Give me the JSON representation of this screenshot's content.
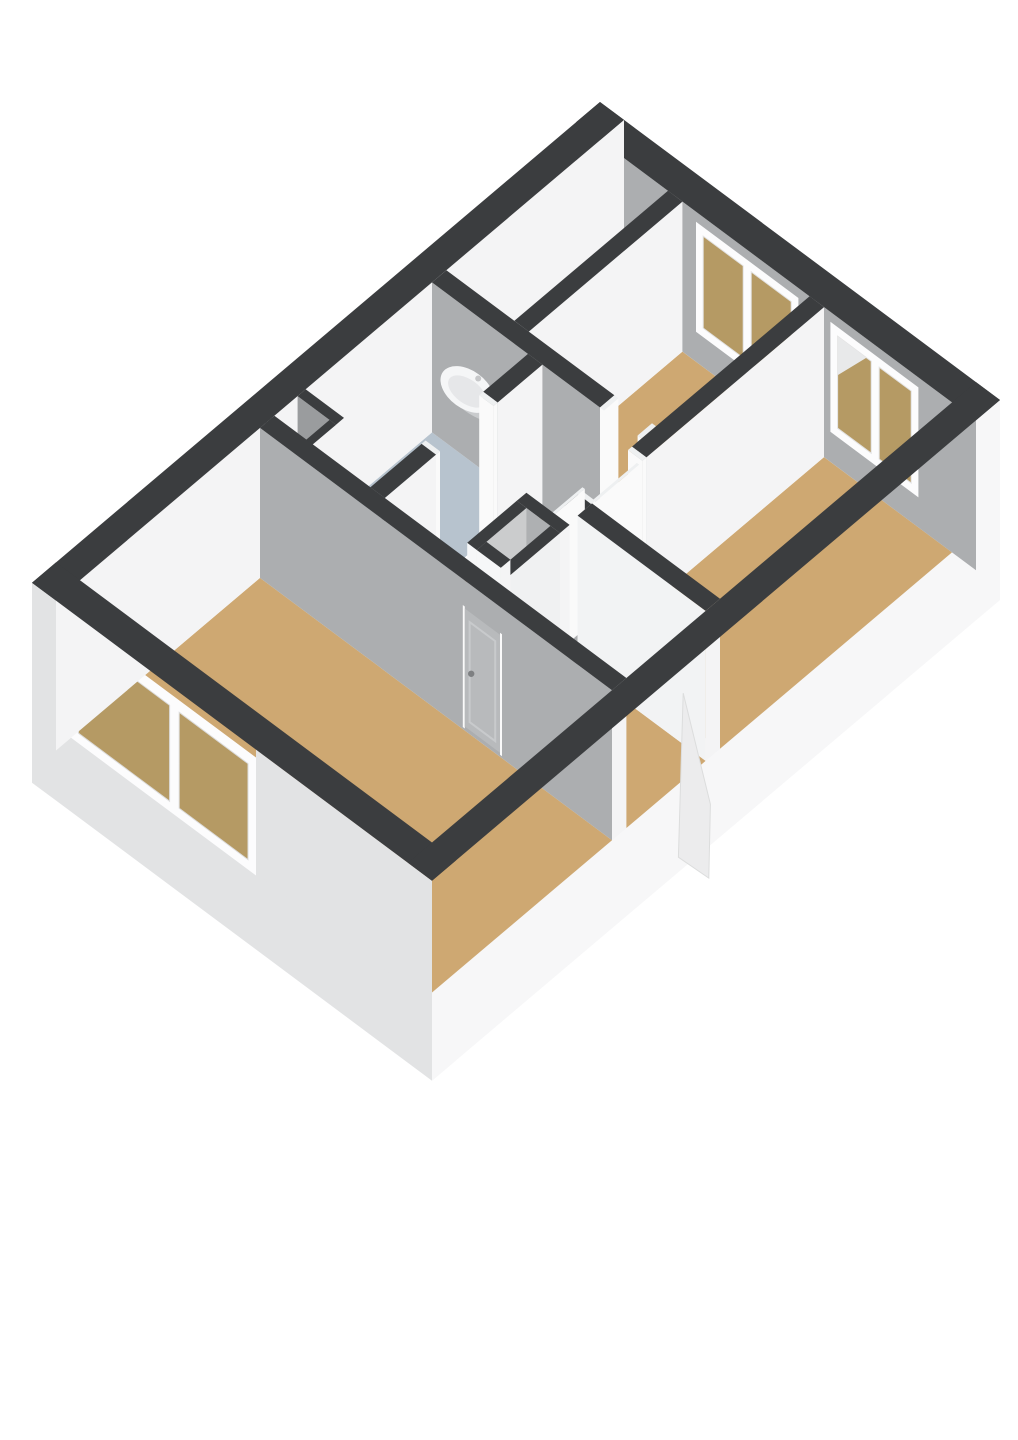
{
  "scene": {
    "kind": "3d-floorplan-render",
    "background": "#ffffff",
    "projection": "isometric-top-down",
    "canvas": {
      "width": 1018,
      "height": 1440
    }
  },
  "colors": {
    "wall_top": "#3b3d3f",
    "face_light": "#f4f4f5",
    "face_shaded": "#acaeb0",
    "ext_face_sw": "#e2e3e4",
    "ext_face_se": "#f7f7f8",
    "floor_wood": "#cea872",
    "floor_bath": "#b7c3ce",
    "floor_gray": "#d7d8d9",
    "closet_floor": "#c6c7c9",
    "closet_cavity_face": "#aeb0b2",
    "closet_inner_face": "#cbcccd",
    "closet_outer_white": "#f6f7f8",
    "shaft_dark": "#8f9193",
    "shaft_inner": "#9a9c9e",
    "window_frame": "#fcfcfd",
    "glass": "#b59a64",
    "glass_sparkle": "#e8e9ea",
    "door_panel": "#b8babc",
    "door_trim": "#c8cacc",
    "jamb_white": "#fafafa",
    "jamb_top": "#eef0f1",
    "handle": "#7e8082",
    "flap": "#ececed",
    "flap_edge": "#dcdddd",
    "sink_white": "#f5f6f7",
    "sink_inner": "#e6e7e9",
    "sink_shadow": "#c9cbcd",
    "bright_wall_override": "#f2f3f4"
  },
  "rooms": [
    {
      "id": "living-room",
      "floor": "wood",
      "features": [
        "large-two-pane-window",
        "closed-door-with-handle"
      ]
    },
    {
      "id": "bathroom",
      "floor": "tile-blue",
      "fixtures": [
        "washbasin"
      ]
    },
    {
      "id": "bedroom-1",
      "floor": "wood",
      "features": [
        "two-pane-window",
        "open-doorway"
      ]
    },
    {
      "id": "bedroom-2",
      "floor": "wood",
      "features": [
        "two-pane-window",
        "open-doorway"
      ]
    },
    {
      "id": "hallway",
      "floor": "wood",
      "features": [
        "storage-closet",
        "front-door-open"
      ]
    },
    {
      "id": "storage-closet",
      "floor": "concrete",
      "features": []
    },
    {
      "id": "duct-shaft",
      "floor": "none",
      "features": []
    }
  ],
  "windows": [
    {
      "room": "bedroom-1",
      "panes": 2,
      "wall": "top-right"
    },
    {
      "room": "bedroom-2",
      "panes": 2,
      "wall": "top-right",
      "reflection": true
    },
    {
      "room": "living-room",
      "panes": 2,
      "wall": "bottom-left"
    }
  ],
  "doors": [
    {
      "room": "living-room",
      "state": "closed",
      "handle": true
    },
    {
      "room": "bathroom",
      "state": "open"
    },
    {
      "room": "bedroom-1",
      "state": "open"
    },
    {
      "room": "bedroom-2",
      "state": "open"
    },
    {
      "room": "entrance",
      "state": "open",
      "leaf_outside": true
    }
  ],
  "fixtures": [
    {
      "id": "washbasin",
      "room": "bathroom",
      "faucet": true
    }
  ]
}
